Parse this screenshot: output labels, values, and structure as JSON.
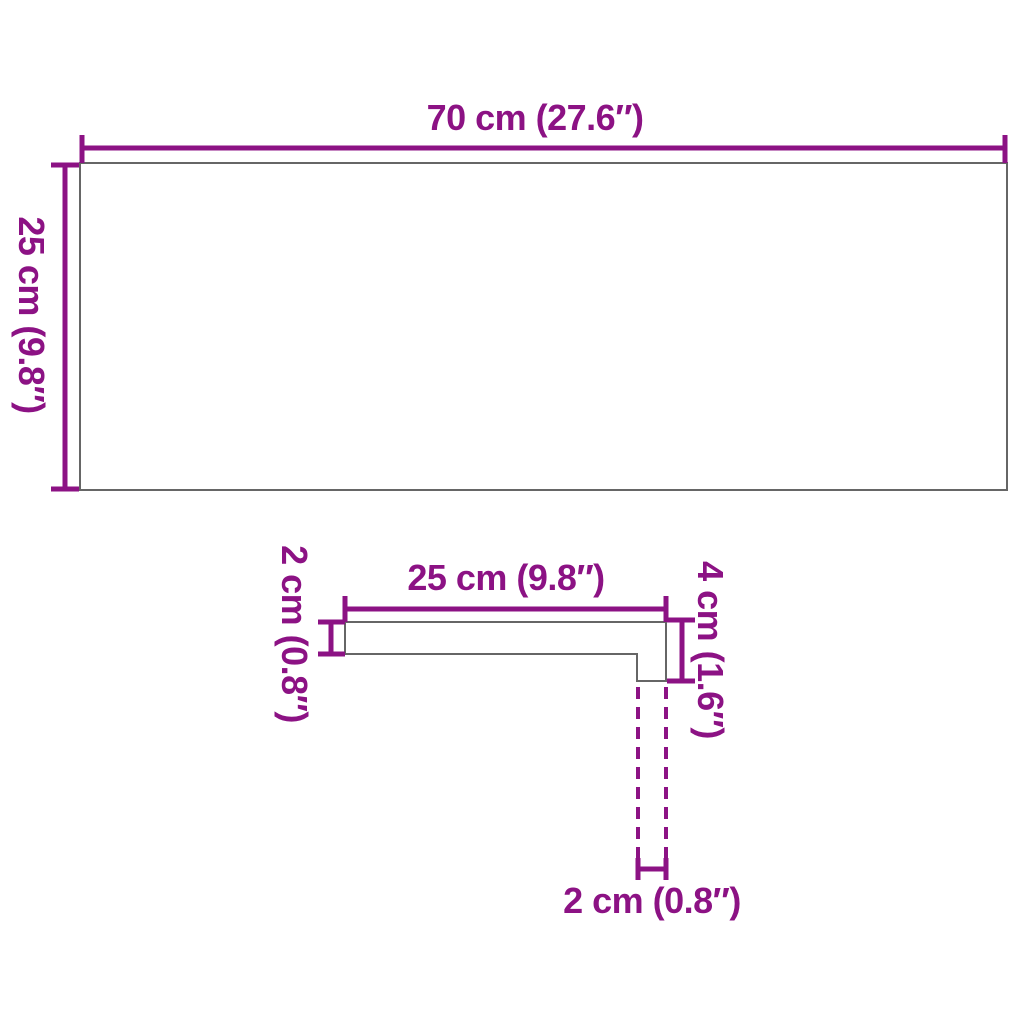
{
  "colors": {
    "dimension": "#8C1284",
    "outline": "#666666",
    "background": "#FFFFFF"
  },
  "top_view": {
    "width_label": "70 cm (27.6″)",
    "height_label": "25 cm (9.8″)"
  },
  "profile_view": {
    "width_label": "25 cm (9.8″)",
    "thickness_label": "2 cm (0.8″)",
    "edge_height_label": "4 cm (1.6″)",
    "nose_depth_label": "2 cm (0.8″)"
  }
}
